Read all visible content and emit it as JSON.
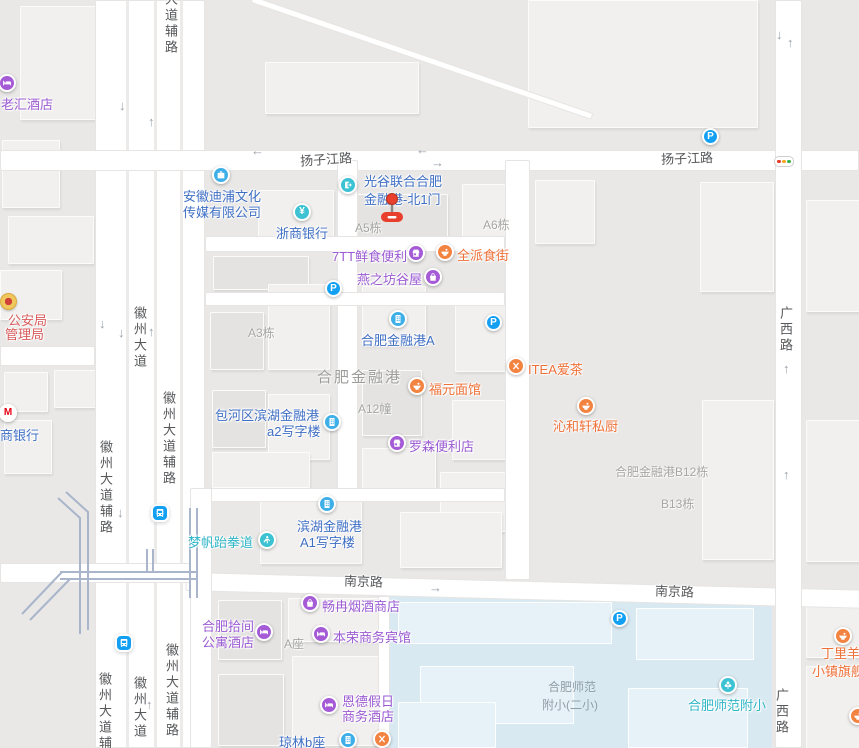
{
  "map": {
    "colors": {
      "block": "#e9e8e6",
      "building": "#f1f0ee",
      "road": "#ffffff",
      "school_area": "#d8e9f2",
      "school_building": "#e7f2f8",
      "poi_text_blue": "#3f6fc4",
      "poi_text_purple": "#9b5bd2",
      "poi_text_orange": "#ee7038",
      "poi_text_teal": "#2eb5c6",
      "poi_text_red": "#d85a5a",
      "icon_blue": "#3fafe8",
      "icon_teal": "#3cc2d2",
      "icon_purple": "#a55ad6",
      "icon_orange": "#f28340",
      "parking_blue": "#13a0f3",
      "marker_red": "#e8402d",
      "traffic_red": "#e23b2e",
      "traffic_yellow": "#f5a623",
      "traffic_green": "#37b24d"
    },
    "road_labels": [
      {
        "text": "大道辅路",
        "x": 161,
        "y": -8,
        "vertical": true
      },
      {
        "text": "扬子江路",
        "x": 300,
        "y": 149,
        "rotate": -4
      },
      {
        "text": "扬子江路",
        "x": 661,
        "y": 148,
        "rotate": -2
      },
      {
        "text": "广西路",
        "x": 776,
        "y": 306,
        "vertical": true
      },
      {
        "text": "徽州大道",
        "x": 130,
        "y": 306,
        "vertical": true
      },
      {
        "text": "徽州大道辅路",
        "x": 159,
        "y": 391,
        "vertical": true
      },
      {
        "text": "徽州大道辅路",
        "x": 96,
        "y": 440,
        "vertical": true
      },
      {
        "text": "南京路",
        "x": 344,
        "y": 571,
        "rotate": 2
      },
      {
        "text": "南京路",
        "x": 655,
        "y": 581,
        "rotate": 2
      },
      {
        "text": "徽州大道辅路",
        "x": 162,
        "y": 643,
        "vertical": true
      },
      {
        "text": "徽州大道",
        "x": 130,
        "y": 676,
        "vertical": true
      },
      {
        "text": "徽州大道辅路",
        "x": 95,
        "y": 672,
        "vertical": true
      },
      {
        "text": "广西路",
        "x": 772,
        "y": 688,
        "vertical": true
      }
    ],
    "building_labels": [
      {
        "text": "A5栋",
        "x": 355,
        "y": 219
      },
      {
        "text": "A6栋",
        "x": 483,
        "y": 216
      },
      {
        "text": "A3栋",
        "x": 248,
        "y": 324
      },
      {
        "text": "合肥金融港",
        "x": 317,
        "y": 366,
        "big": true
      },
      {
        "text": "A12幢",
        "x": 358,
        "y": 400
      },
      {
        "text": "合肥金融港B12栋",
        "x": 615,
        "y": 463
      },
      {
        "text": "B13栋",
        "x": 661,
        "y": 495
      },
      {
        "text": "A座",
        "x": 284,
        "y": 635
      },
      {
        "text": "合肥师范",
        "x": 548,
        "y": 678,
        "school": true
      },
      {
        "text": "附小(二小)",
        "x": 542,
        "y": 696,
        "school": true
      }
    ],
    "pois": [
      {
        "id": "laohui-hotel",
        "icon": "bed",
        "cat": "purple",
        "ix": 7,
        "iy": 83,
        "tcat": "purple",
        "lines": [
          {
            "t": "老汇酒店",
            "x": 1,
            "y": 94
          }
        ]
      },
      {
        "id": "anhui-dipu-culture-media",
        "icon": "briefcase",
        "cat": "blue",
        "ix": 221,
        "iy": 175,
        "tcat": "blue",
        "lines": [
          {
            "t": "安徽迪浦文化",
            "x": 183,
            "y": 186
          },
          {
            "t": "传媒有限公司",
            "x": 183,
            "y": 202
          }
        ]
      },
      {
        "id": "zheshang-bank",
        "icon": "yen",
        "glyph": "¥",
        "cat": "teal",
        "ix": 302,
        "iy": 212,
        "tcat": "blue",
        "lines": [
          {
            "t": "浙商银行",
            "x": 276,
            "y": 223
          }
        ]
      },
      {
        "id": "guanggu-united-hefei-financial-port-north-gate-1",
        "icon": "gate",
        "cat": "teal",
        "ix": 348,
        "iy": 185,
        "tcat": "blue",
        "lines": [
          {
            "t": "光谷联合合肥",
            "x": 364,
            "y": 171
          },
          {
            "t": "金融港-北1门",
            "x": 364,
            "y": 189
          }
        ]
      },
      {
        "id": "7tt-fresh-food-store",
        "icon": "basket",
        "cat": "purple",
        "ix": 416,
        "iy": 253,
        "tcat": "purple",
        "lines": [
          {
            "t": "7TT鲜食便利",
            "x": 332,
            "y": 246
          }
        ]
      },
      {
        "id": "quanpai-food-street",
        "icon": "bowl",
        "cat": "orange",
        "ix": 445,
        "iy": 252,
        "tcat": "orange",
        "lines": [
          {
            "t": "全派食街",
            "x": 457,
            "y": 245
          }
        ]
      },
      {
        "id": "yanzhifang-guwu",
        "icon": "bag",
        "cat": "purple",
        "ix": 433,
        "iy": 277,
        "tcat": "purple",
        "lines": [
          {
            "t": "燕之坊谷屋",
            "x": 357,
            "y": 269
          }
        ]
      },
      {
        "id": "hefei-financial-port-a",
        "icon": "building",
        "cat": "blue",
        "ix": 398,
        "iy": 319,
        "tcat": "blue",
        "lines": [
          {
            "t": "合肥金融港A",
            "x": 361,
            "y": 330
          }
        ]
      },
      {
        "id": "fuyuan-noodle-house",
        "icon": "bowl",
        "cat": "orange",
        "ix": 417,
        "iy": 386,
        "tcat": "orange",
        "lines": [
          {
            "t": "福元面馆",
            "x": 429,
            "y": 379
          }
        ]
      },
      {
        "id": "baohe-binhu-financial-port-a2-office",
        "icon": "building",
        "cat": "blue",
        "ix": 332,
        "iy": 422,
        "tcat": "blue",
        "lines": [
          {
            "t": "包河区滨湖金融港",
            "x": 215,
            "y": 405
          },
          {
            "t": "a2写字楼",
            "x": 267,
            "y": 421
          }
        ]
      },
      {
        "id": "lawson-store",
        "icon": "basket",
        "cat": "purple",
        "ix": 397,
        "iy": 443,
        "tcat": "purple",
        "lines": [
          {
            "t": "罗森便利店",
            "x": 409,
            "y": 436
          }
        ]
      },
      {
        "id": "itea-tea",
        "icon": "utensils",
        "cat": "orange",
        "ix": 516,
        "iy": 366,
        "tcat": "orange",
        "lines": [
          {
            "t": "ITEA爱茶",
            "x": 528,
            "y": 359
          }
        ]
      },
      {
        "id": "qinhexuan-private-kitchen",
        "icon": "bowl",
        "cat": "orange",
        "ix": 586,
        "iy": 406,
        "tcat": "orange",
        "lines": [
          {
            "t": "沁和轩私厨",
            "x": 553,
            "y": 416
          }
        ]
      },
      {
        "id": "binhu-financial-port-a1-office",
        "icon": "building",
        "cat": "blue",
        "ix": 327,
        "iy": 504,
        "tcat": "blue",
        "lines": [
          {
            "t": "滨湖金融港",
            "x": 297,
            "y": 516
          },
          {
            "t": "A1写字楼",
            "x": 300,
            "y": 532
          }
        ]
      },
      {
        "id": "mengfan-taekwondo",
        "icon": "person",
        "cat": "teal",
        "ix": 267,
        "iy": 540,
        "tcat": "teal",
        "lines": [
          {
            "t": "梦帆跆拳道",
            "x": 188,
            "y": 532
          }
        ]
      },
      {
        "id": "changran-tobacco-wine-shop",
        "icon": "bag",
        "cat": "purple",
        "ix": 310,
        "iy": 603,
        "tcat": "purple",
        "lines": [
          {
            "t": "畅冉烟酒商店",
            "x": 322,
            "y": 596
          }
        ]
      },
      {
        "id": "hefei-shijian-apartment-hotel",
        "icon": "bed",
        "cat": "purple",
        "ix": 264,
        "iy": 632,
        "tcat": "purple",
        "lines": [
          {
            "t": "合肥拾间",
            "x": 202,
            "y": 616
          },
          {
            "t": "公寓酒店",
            "x": 202,
            "y": 632
          }
        ]
      },
      {
        "id": "benrong-business-hotel",
        "icon": "bed",
        "cat": "purple",
        "ix": 321,
        "iy": 634,
        "tcat": "purple",
        "lines": [
          {
            "t": "本荣商务宾馆",
            "x": 333,
            "y": 627
          }
        ]
      },
      {
        "id": "ende-holiday-business-hotel",
        "icon": "bed",
        "cat": "purple",
        "ix": 329,
        "iy": 705,
        "tcat": "purple",
        "lines": [
          {
            "t": "恩德假日",
            "x": 342,
            "y": 691
          },
          {
            "t": "商务酒店",
            "x": 342,
            "y": 706
          }
        ]
      },
      {
        "id": "qionglin-block-b",
        "icon": "building",
        "cat": "blue",
        "ix": 348,
        "iy": 740,
        "tcat": "blue",
        "lines": [
          {
            "t": "琼林b座",
            "x": 279,
            "y": 732
          }
        ]
      },
      {
        "id": "hefei-shifan-fuxiao",
        "icon": "leaf",
        "cat": "teal",
        "ix": 728,
        "iy": 685,
        "tcat": "teal",
        "lines": [
          {
            "t": "合肥师范附小",
            "x": 688,
            "y": 695
          }
        ]
      },
      {
        "id": "dingliyang-town-flagship",
        "icon": "bowl",
        "cat": "orange",
        "ix": 843,
        "iy": 636,
        "tcat": "orange",
        "lines": [
          {
            "t": "丁里羊",
            "x": 821,
            "y": 643
          },
          {
            "t": "小镇旗舰店",
            "x": 812,
            "y": 661
          }
        ]
      },
      {
        "id": "zhaoshang-bank",
        "icon": "mbank",
        "glyph": "M",
        "cat": "white",
        "ix": 8,
        "iy": 413,
        "tcat": "blue",
        "lines": [
          {
            "t": "商银行",
            "x": 0,
            "y": 425
          }
        ]
      },
      {
        "id": "public-security-bureau",
        "icon": "emblem",
        "cat": "gold",
        "ix": 7,
        "iy": 300,
        "tcat": "red",
        "lines": [
          {
            "t": "公安局",
            "x": 8,
            "y": 310
          },
          {
            "t": "管理局",
            "x": 5,
            "y": 324
          }
        ]
      }
    ],
    "standalone_icons": [
      {
        "icon": "parking",
        "glyph": "P",
        "x": 710,
        "y": 136
      },
      {
        "icon": "parking",
        "glyph": "P",
        "x": 333,
        "y": 288
      },
      {
        "icon": "parking",
        "glyph": "P",
        "x": 493,
        "y": 322
      },
      {
        "icon": "parking",
        "glyph": "P",
        "x": 619,
        "y": 618
      },
      {
        "icon": "traffic-light",
        "x": 783,
        "y": 160
      },
      {
        "icon": "metro",
        "x": 160,
        "y": 513
      },
      {
        "icon": "metro",
        "x": 124,
        "y": 643
      },
      {
        "icon": "utensils-orange",
        "x": 382,
        "y": 739
      },
      {
        "icon": "bowl-orange",
        "x": 858,
        "y": 716
      }
    ],
    "arrows": [
      {
        "dir": "down",
        "x": 125,
        "y": 106
      },
      {
        "dir": "up",
        "x": 154,
        "y": 122
      },
      {
        "dir": "down",
        "x": 105,
        "y": 324
      },
      {
        "dir": "down",
        "x": 124,
        "y": 333
      },
      {
        "dir": "up",
        "x": 154,
        "y": 332
      },
      {
        "dir": "down",
        "x": 123,
        "y": 513
      },
      {
        "dir": "up",
        "x": 152,
        "y": 705
      },
      {
        "dir": "down",
        "x": 782,
        "y": 35
      },
      {
        "dir": "up",
        "x": 793,
        "y": 43
      },
      {
        "dir": "up",
        "x": 789,
        "y": 369
      },
      {
        "dir": "up",
        "x": 789,
        "y": 475
      },
      {
        "dir": "left",
        "x": 257,
        "y": 151
      },
      {
        "dir": "left",
        "x": 422,
        "y": 150
      },
      {
        "dir": "right",
        "x": 437,
        "y": 163
      },
      {
        "dir": "right",
        "x": 435,
        "y": 588
      }
    ],
    "marker": {
      "x": 392,
      "y": 199
    }
  }
}
